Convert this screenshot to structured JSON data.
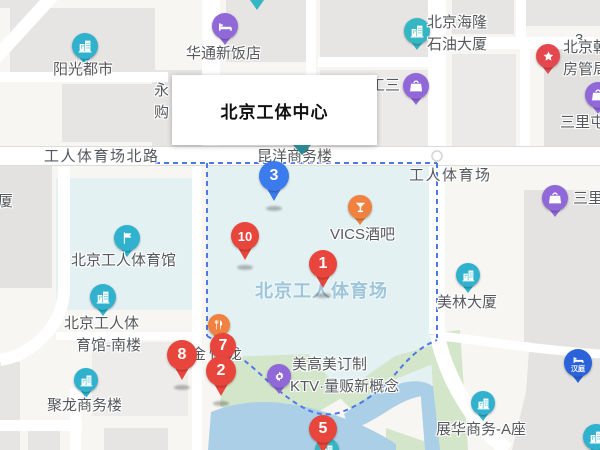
{
  "infobox": {
    "title": "北京工体中心"
  },
  "colors": {
    "red": "#e8453c",
    "blue": "#3c7bed",
    "purple": "#9168d8",
    "cyan": "#30b2cf",
    "teal": "#35b6c3",
    "orange": "#f0813f",
    "pinkred": "#e5474f",
    "hanting": "#2a62d9",
    "water": "#accfe8",
    "green": "#d4e6ca",
    "stadium_fill": "#e4f1f2",
    "boundary": "#4b79e8"
  },
  "labels": [
    {
      "name": "road-gongti-north-rd",
      "text": "工人体育场北路",
      "x": 44,
      "y": 149,
      "cls": "road"
    },
    {
      "name": "road-workers-stadium",
      "text": "工人体育场",
      "x": 409,
      "y": 168,
      "cls": "road"
    },
    {
      "name": "area-workers-stadium",
      "text": "北京工人体育场",
      "x": 255,
      "y": 282,
      "cls": "area"
    },
    {
      "name": "partial-label-3",
      "text": "3",
      "x": 575,
      "y": 32,
      "cls": "road"
    },
    {
      "name": "partial-label-sha",
      "text": "厦",
      "x": -2,
      "y": 194,
      "cls": ""
    },
    {
      "name": "partial-label-yong",
      "text": "永",
      "x": 154,
      "y": 83,
      "cls": ""
    },
    {
      "name": "partial-label-gou",
      "text": "购",
      "x": 154,
      "y": 105,
      "cls": ""
    },
    {
      "name": "label-shangwu-lou",
      "text": "昆洋商务楼",
      "x": 257,
      "y": 149,
      "cls": ""
    },
    {
      "name": "label-jin-long",
      "text": "金悦龙",
      "x": 191,
      "y": 347,
      "cls": "ls3"
    }
  ],
  "poi": [
    {
      "name": "yangguang-dushi",
      "icon": "building",
      "color": "cyan",
      "x": 85,
      "y": 46,
      "r": 13,
      "labels": [
        {
          "text": "阳光都市",
          "x": 53,
          "y": 62
        }
      ]
    },
    {
      "name": "huatong-hotel",
      "icon": "bed",
      "color": "purple",
      "x": 225,
      "y": 26,
      "r": 13,
      "labels": [
        {
          "text": "华通新饭店",
          "x": 186,
          "y": 46
        }
      ]
    },
    {
      "name": "hailong-petroleum-tower",
      "icon": "building",
      "color": "teal",
      "x": 417,
      "y": 31,
      "r": 13,
      "labels": [
        {
          "text": "北京海隆",
          "x": 427,
          "y": 15
        },
        {
          "text": "石油大厦",
          "x": 427,
          "y": 37
        }
      ]
    },
    {
      "name": "gongsan-mall",
      "icon": "bag",
      "color": "purple",
      "x": 416,
      "y": 86,
      "r": 13,
      "labels": [
        {
          "text": "工三",
          "x": 370,
          "y": 78
        }
      ]
    },
    {
      "name": "chaoyang-housing-bureau",
      "icon": "star",
      "color": "pinkred",
      "x": 548,
      "y": 56,
      "r": 12,
      "labels": [
        {
          "text": "北京朝",
          "x": 563,
          "y": 40
        },
        {
          "text": "房管局",
          "x": 563,
          "y": 62
        }
      ]
    },
    {
      "name": "sanlitun-upper",
      "icon": "bag",
      "color": "purple",
      "x": 598,
      "y": 95,
      "r": 13,
      "labels": [
        {
          "text": "三里屯",
          "x": 560,
          "y": 115
        }
      ]
    },
    {
      "name": "sanlitun-lower",
      "icon": "bag",
      "color": "purple",
      "x": 555,
      "y": 198,
      "r": 13,
      "labels": [
        {
          "text": "三里",
          "x": 573,
          "y": 191
        }
      ]
    },
    {
      "name": "vics-bar",
      "icon": "cocktail",
      "color": "orange",
      "x": 360,
      "y": 207,
      "r": 12,
      "labels": [
        {
          "text": "VICS酒吧",
          "x": 330,
          "y": 227
        }
      ]
    },
    {
      "name": "workers-gymnasium",
      "icon": "flag",
      "color": "cyan",
      "x": 127,
      "y": 238,
      "r": 13,
      "labels": [
        {
          "text": "北京工人体育馆",
          "x": 71,
          "y": 253
        }
      ]
    },
    {
      "name": "gymnasium-south-building",
      "icon": "building",
      "color": "cyan",
      "x": 103,
      "y": 297,
      "r": 13,
      "labels": [
        {
          "text": "北京工人体",
          "x": 64,
          "y": 316
        },
        {
          "text": "育馆-南楼",
          "x": 76,
          "y": 338
        }
      ]
    },
    {
      "name": "julong-office-tower",
      "icon": "building",
      "color": "cyan",
      "x": 86,
      "y": 380,
      "r": 12,
      "labels": [
        {
          "text": "聚龙商务楼",
          "x": 47,
          "y": 398
        }
      ]
    },
    {
      "name": "restaurant-pin",
      "icon": "cutlery",
      "color": "orange",
      "x": 219,
      "y": 325,
      "r": 11,
      "labels": []
    },
    {
      "name": "meigaomei-ktv",
      "icon": "gear",
      "color": "purple",
      "x": 279,
      "y": 376,
      "r": 12,
      "labels": [
        {
          "text": "美高美订制",
          "x": 292,
          "y": 357
        },
        {
          "text": "KTV·量贩新概念",
          "x": 290,
          "y": 379
        }
      ]
    },
    {
      "name": "meilin-tower",
      "icon": "building",
      "color": "cyan",
      "x": 468,
      "y": 275,
      "r": 12,
      "labels": [
        {
          "text": "美林大厦",
          "x": 437,
          "y": 295
        }
      ]
    },
    {
      "name": "zhanhua-business-a",
      "icon": "building",
      "color": "cyan",
      "x": 483,
      "y": 403,
      "r": 12,
      "labels": [
        {
          "text": "展华商务-A座",
          "x": 436,
          "y": 422
        }
      ]
    },
    {
      "name": "hanting-hotel",
      "icon": "bed",
      "color": "hanting",
      "x": 578,
      "y": 363,
      "r": 14,
      "inner": "汉庭",
      "labels": []
    },
    {
      "name": "clipped-poi-bottom-right",
      "icon": "building",
      "color": "cyan",
      "x": 596,
      "y": 437,
      "r": 13,
      "labels": []
    },
    {
      "name": "clipped-poi-bottom-center",
      "icon": "building",
      "color": "teal",
      "x": 327,
      "y": 450,
      "r": 12,
      "labels": []
    }
  ],
  "markers": [
    {
      "name": "marker-3",
      "num": "3",
      "color": "blue",
      "x": 274,
      "y": 176,
      "r": 15
    },
    {
      "name": "marker-10",
      "num": "10",
      "color": "red",
      "x": 245,
      "y": 236,
      "r": 14
    },
    {
      "name": "marker-1",
      "num": "1",
      "color": "red",
      "x": 323,
      "y": 264,
      "r": 14
    },
    {
      "name": "marker-8",
      "num": "8",
      "color": "red",
      "x": 182,
      "y": 355,
      "r": 15
    },
    {
      "name": "marker-7",
      "num": "7",
      "color": "red",
      "x": 223,
      "y": 346,
      "r": 13
    },
    {
      "name": "marker-2",
      "num": "2",
      "color": "red",
      "x": 221,
      "y": 371,
      "r": 15
    },
    {
      "name": "marker-5",
      "num": "5",
      "color": "red",
      "x": 323,
      "y": 429,
      "r": 14
    }
  ]
}
